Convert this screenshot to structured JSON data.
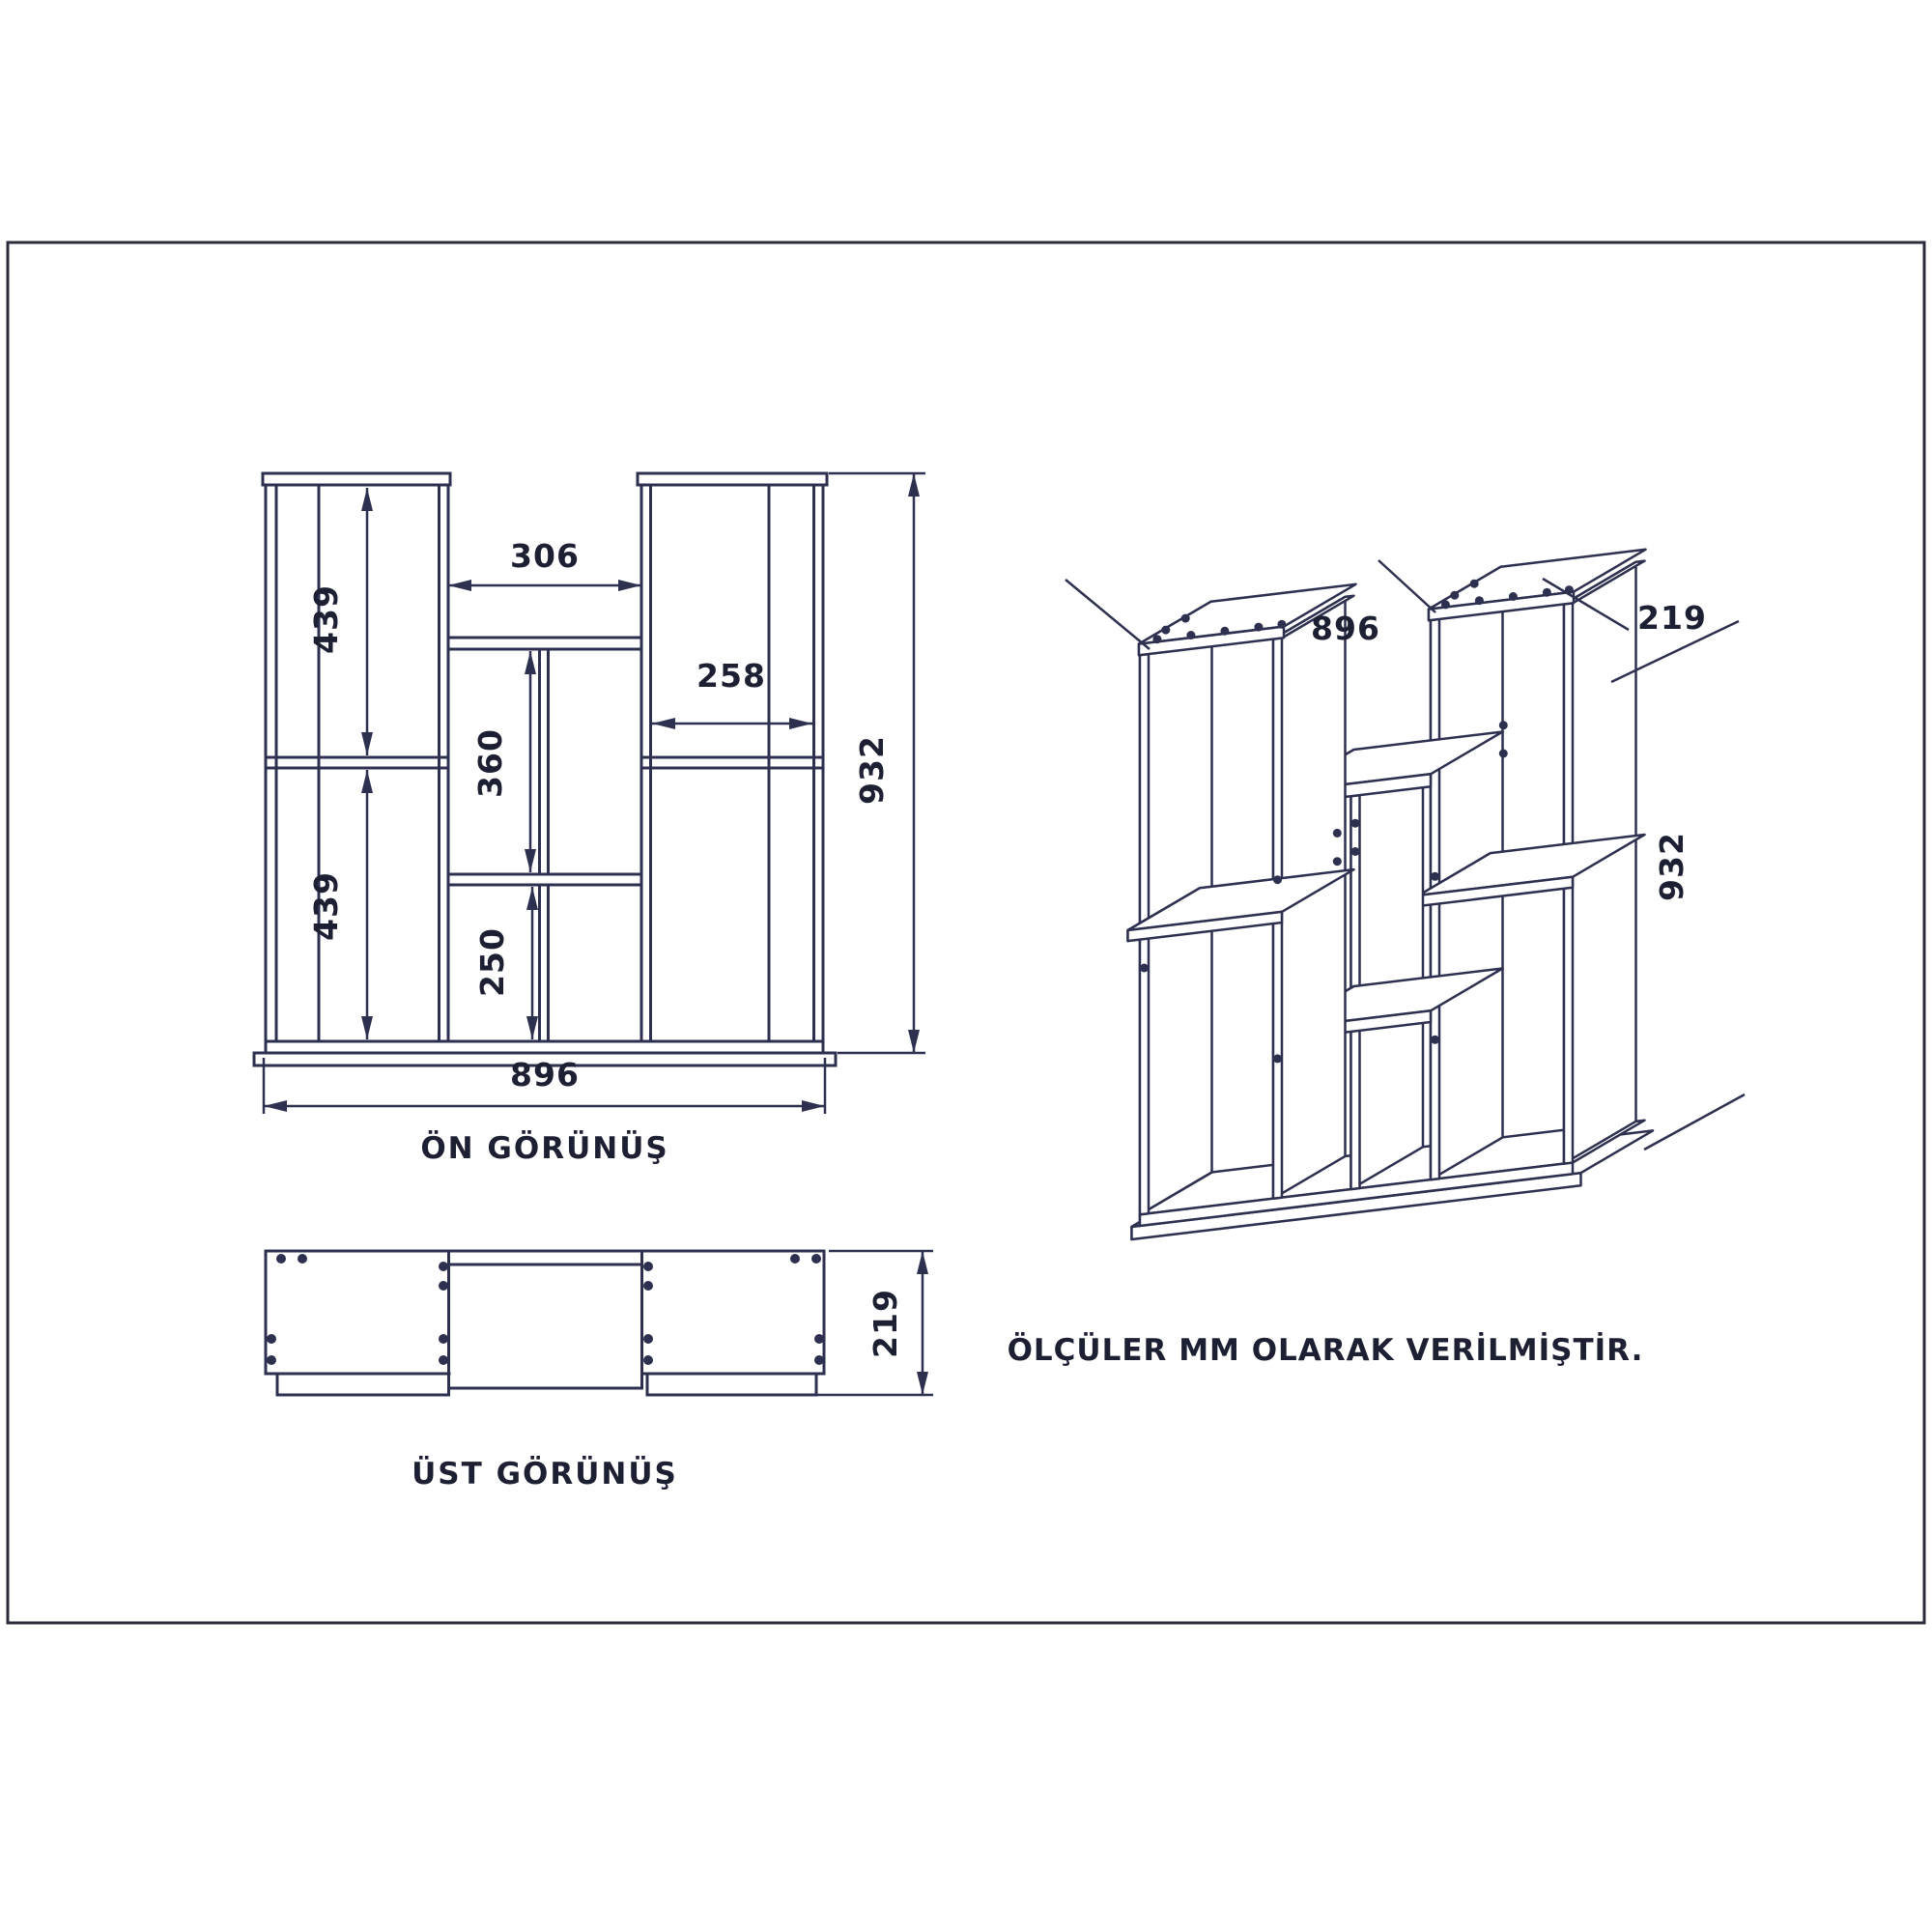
{
  "note_text": "ÖLÇÜLER MM OLARAK VERİLMİŞTİR.",
  "colors": {
    "background": "#ffffff",
    "line": "#2e3050",
    "text": "#1d1f33",
    "frame": "#2b2d3d"
  },
  "front_view": {
    "title": "ÖN GÖRÜNÜŞ",
    "dims": {
      "upper_left": "439",
      "lower_left": "439",
      "middle_top": "306",
      "middle_mid": "360",
      "middle_bottom": "250",
      "right_shelf": "258",
      "width": "896",
      "height": "932"
    }
  },
  "top_view": {
    "title": "ÜST GÖRÜNÜŞ",
    "dims": {
      "depth": "219"
    }
  },
  "iso_view": {
    "dims": {
      "width": "896",
      "depth": "219",
      "height": "932"
    }
  }
}
